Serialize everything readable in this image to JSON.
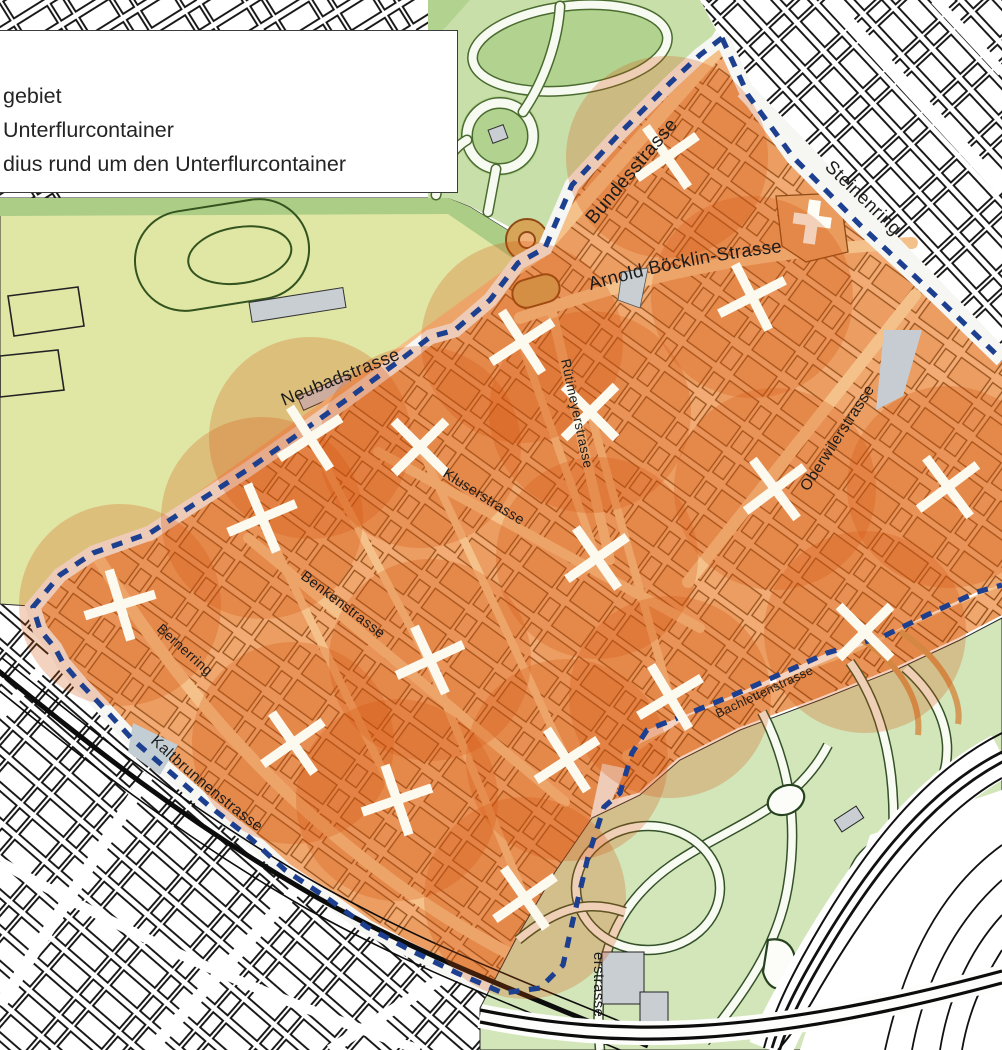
{
  "legend": {
    "items": [
      "gebiet",
      "Unterflurcontainer",
      "dius rund um den Unterflurcontainer"
    ]
  },
  "map": {
    "radius_px": 101,
    "colors": {
      "boundary": "#1d3f8f",
      "radius_fill": "rgba(214,80,10,0.26)",
      "pilot_street": "#f2ab74",
      "pilot_block": "#ea9c60",
      "pilot_outline": "#8f4a15",
      "x_mark": "#fcf9ee",
      "park_yellow": "#e0e6a4",
      "park_green": "#c8dfaa",
      "zoo_green": "#d2e6b9",
      "city_outline": "#141414",
      "gray": "#c9ced3"
    },
    "containers": [
      {
        "x": 667,
        "y": 157,
        "r": 10
      },
      {
        "x": 752,
        "y": 297,
        "r": 18
      },
      {
        "x": 522,
        "y": 342,
        "r": 12
      },
      {
        "x": 590,
        "y": 412,
        "r": 0
      },
      {
        "x": 310,
        "y": 438,
        "r": 12
      },
      {
        "x": 420,
        "y": 447,
        "r": 0
      },
      {
        "x": 262,
        "y": 518,
        "r": 22
      },
      {
        "x": 120,
        "y": 605,
        "r": 28
      },
      {
        "x": 775,
        "y": 489,
        "r": 8
      },
      {
        "x": 948,
        "y": 487,
        "r": 8
      },
      {
        "x": 865,
        "y": 632,
        "r": 0
      },
      {
        "x": 597,
        "y": 558,
        "r": 10
      },
      {
        "x": 430,
        "y": 660,
        "r": 20
      },
      {
        "x": 670,
        "y": 697,
        "r": 14
      },
      {
        "x": 567,
        "y": 760,
        "r": 12
      },
      {
        "x": 293,
        "y": 743,
        "r": 10
      },
      {
        "x": 397,
        "y": 800,
        "r": 26
      },
      {
        "x": 525,
        "y": 898,
        "r": 10
      }
    ],
    "street_labels": [
      {
        "id": "bundesstrasse",
        "text": "Bundesstrasse",
        "x": 594,
        "y": 225,
        "rot": -50,
        "size": 19
      },
      {
        "id": "steinenring",
        "text": "Steinenring",
        "x": 824,
        "y": 168,
        "rot": 44,
        "size": 18.5
      },
      {
        "id": "arnold-boecklin-strasse",
        "text": "Arnold Böcklin-Strasse",
        "path": "pathArnold",
        "offset": "2%",
        "size": 18.5
      },
      {
        "id": "neubadstrasse",
        "text": "Neubadstrasse",
        "x": 284,
        "y": 406,
        "rot": -22,
        "size": 18
      },
      {
        "id": "ruetimeyerstrasse",
        "text": "Rütimeyerstrasse",
        "x": 561,
        "y": 360,
        "rot": 78,
        "size": 13.5
      },
      {
        "id": "oberwilerstrasse",
        "text": "Oberwilerstrasse",
        "x": 808,
        "y": 492,
        "rot": -57,
        "size": 15.5
      },
      {
        "id": "kluserstrasse",
        "text": "Kluserstrasse",
        "x": 442,
        "y": 476,
        "rot": 32,
        "size": 14.5
      },
      {
        "id": "benkenstrasse",
        "text": "Benkenstrasse",
        "x": 300,
        "y": 578,
        "rot": 37,
        "size": 14.5
      },
      {
        "id": "bernerring",
        "text": "Bernerring",
        "x": 156,
        "y": 630,
        "rot": 42,
        "size": 14
      },
      {
        "id": "bachlettenstrasse",
        "text": "Bachlettenstrasse",
        "x": 718,
        "y": 718,
        "rot": -25,
        "size": 12.5
      },
      {
        "id": "kaltbrunnenstrasse",
        "text": "Kaltbrunnenstrasse",
        "path": "pathKaltLabel",
        "offset": "0%",
        "size": 15.5
      },
      {
        "id": "erstrasse",
        "text": "erstrasse",
        "x": 594,
        "y": 952,
        "rot": 90,
        "size": 15
      }
    ]
  }
}
